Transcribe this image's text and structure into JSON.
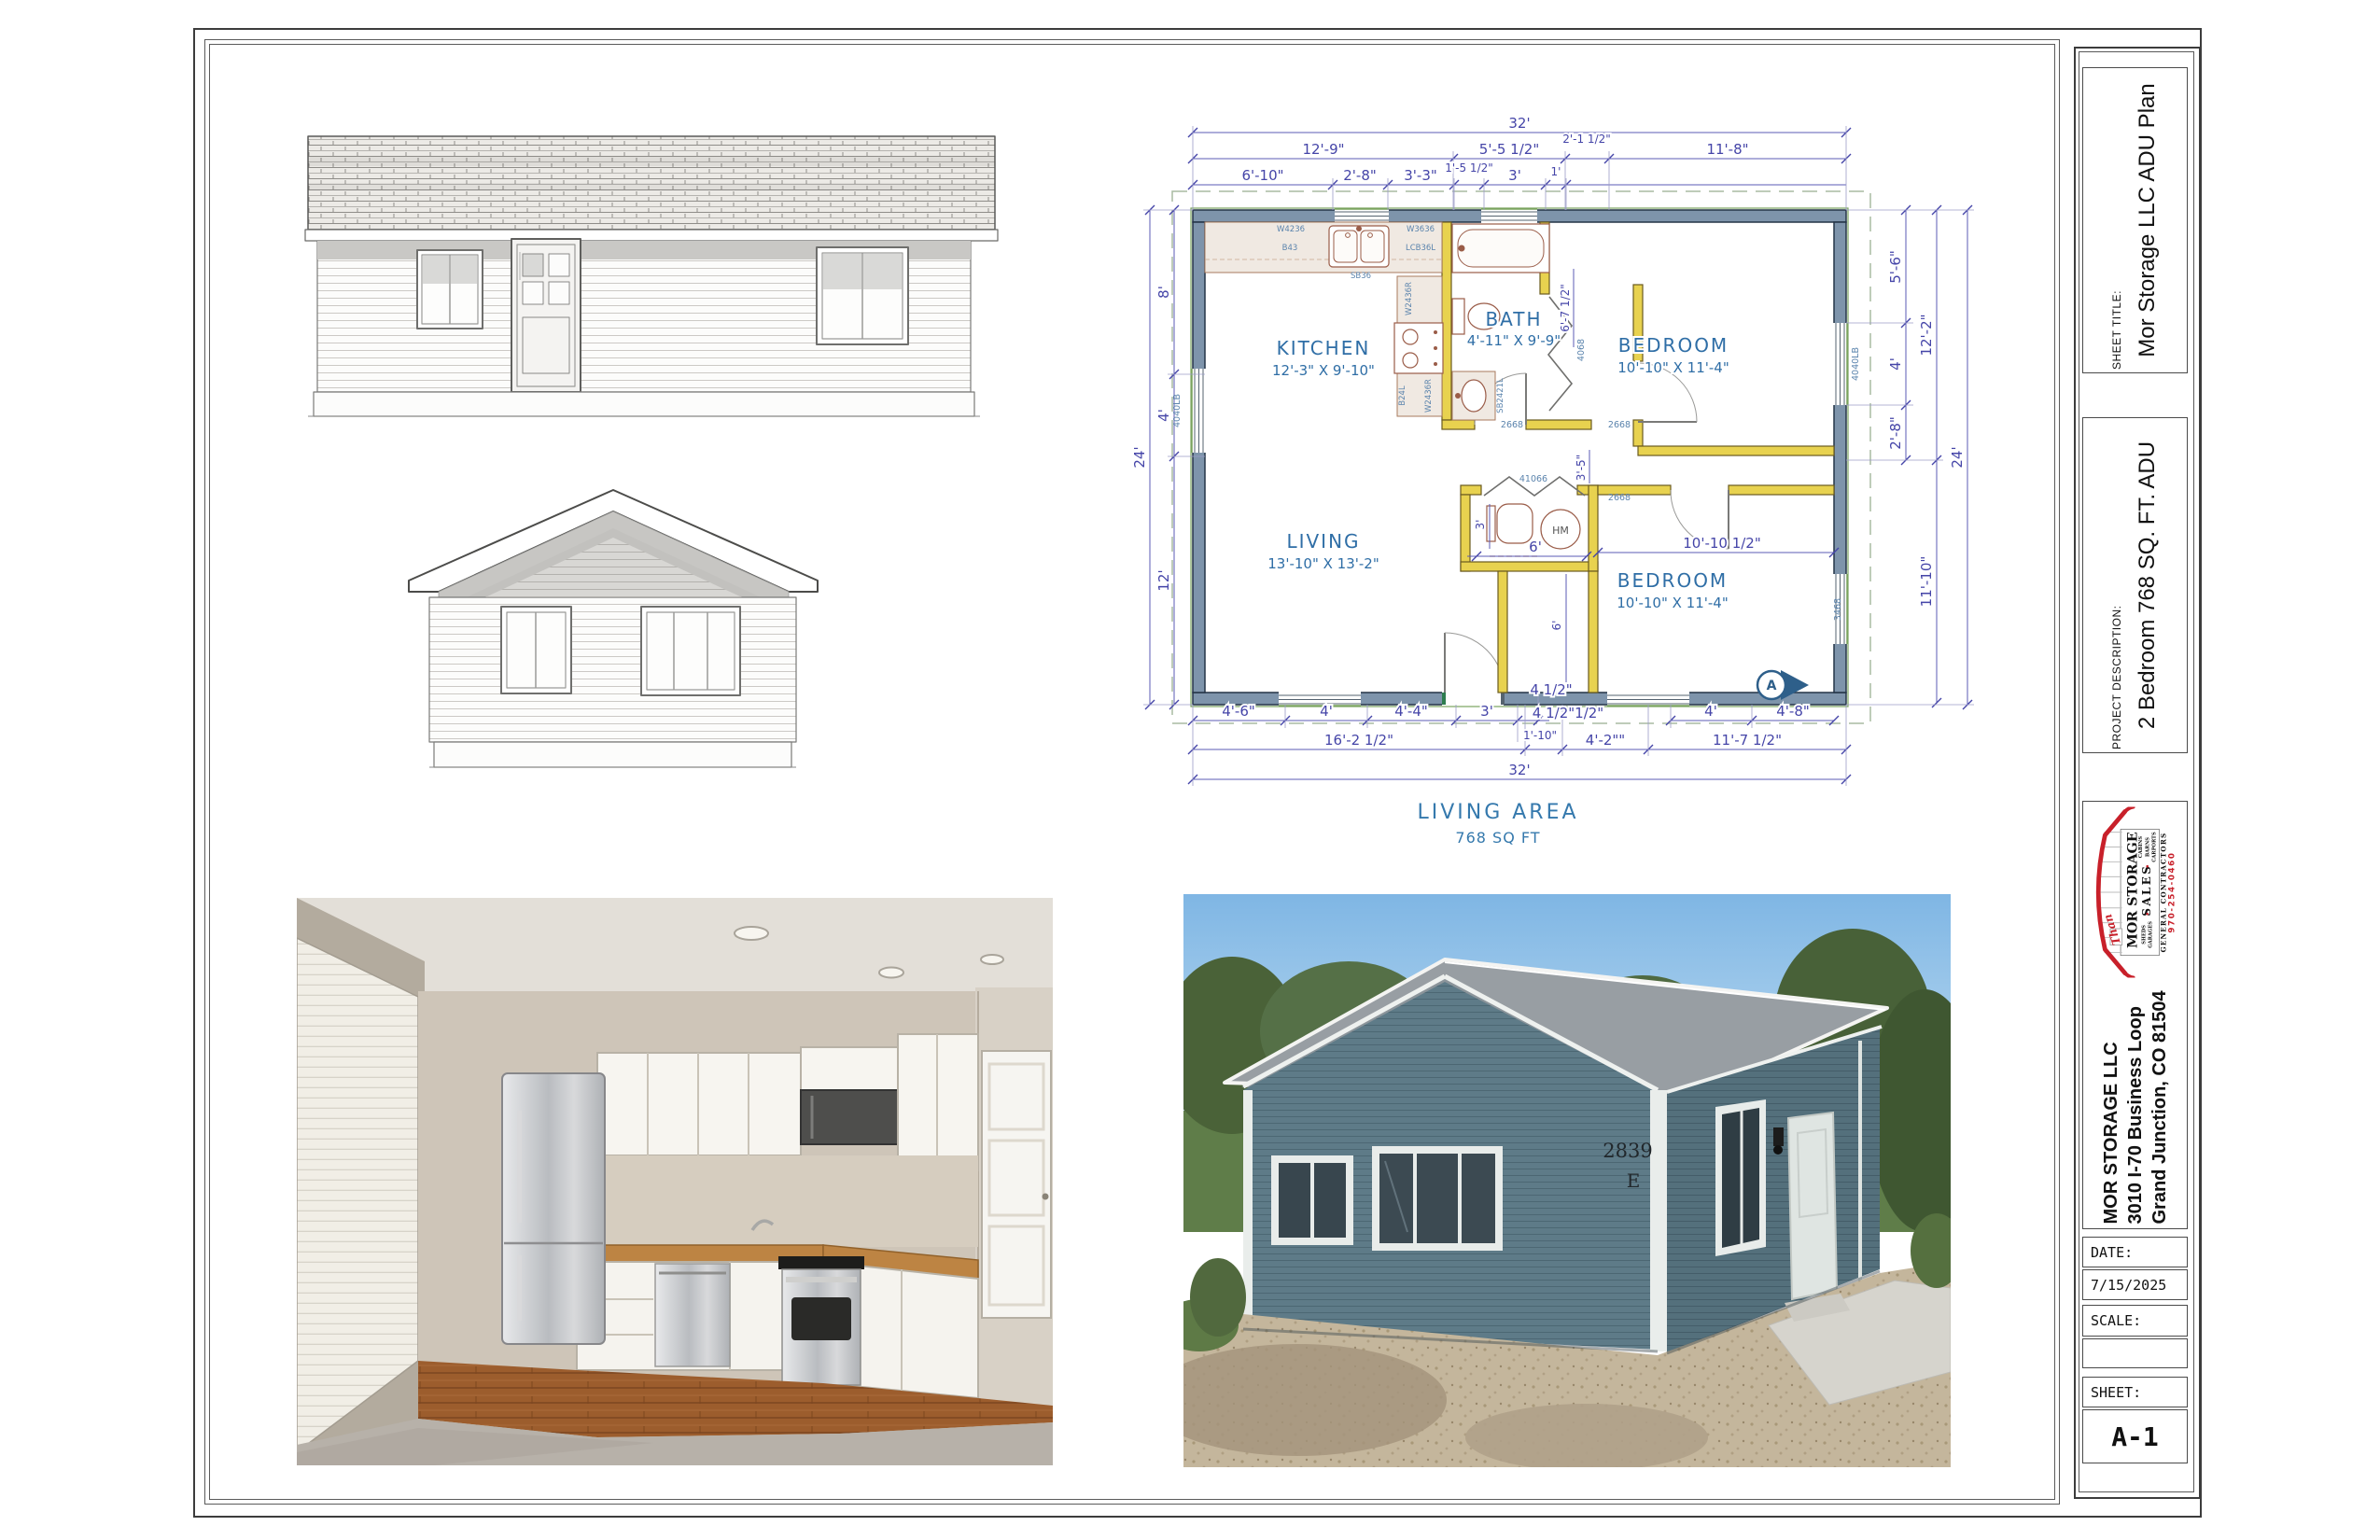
{
  "colors": {
    "wall_fill": "#7e94ab",
    "wall_stroke": "#243447",
    "partition_fill": "#e8d24f",
    "dim_text": "#4545a8",
    "label_text": "#2f6ea6",
    "logo_red": "#c8202a",
    "house_paint": "#5e7b88",
    "sky": "#8fc3ea",
    "counter_wood": "#bd8443"
  },
  "title_block": {
    "sheet_title_label": "SHEET TITLE:",
    "sheet_title": "Mor Storage LLC ADU Plan",
    "project_description_label": "PROJECT DESCRIPTION:",
    "project_description": "2 Bedroom 768 SQ. FT. ADU",
    "company_name": "MOR STORAGE LLC",
    "company_address_line1": "3010 I-70 Business Loop",
    "company_address_line2": "Grand Junction, CO 81504",
    "date_label": "DATE:",
    "date_value": "7/15/2025",
    "scale_label": "SCALE:",
    "scale_value": "",
    "sheet_label": "SHEET:",
    "sheet_number": "A-1",
    "logo": {
      "script": "Than",
      "line1": "MOR STORAGE",
      "line2": "SALES",
      "products": [
        "SHEDS",
        "GARAGES",
        "CABINS",
        "BARNS",
        "CARPORTS"
      ],
      "line3": "GENERAL CONTRACTORS",
      "phone": "970-254-0460"
    }
  },
  "floor_plan": {
    "caption": [
      "LIVING AREA",
      "768 SQ FT"
    ],
    "rooms": [
      {
        "name": "KITCHEN",
        "size": "12'-3\" X 9'-10\""
      },
      {
        "name": "BATH",
        "size": "4'-11\" X 9'-9\""
      },
      {
        "name": "BEDROOM",
        "size": "10'-10\" X 11'-4\""
      },
      {
        "name": "LIVING",
        "size": "13'-10\" X 13'-2\""
      },
      {
        "name": "BEDROOM",
        "size": "10'-10\" X 11'-4\""
      }
    ],
    "dims_top": [
      "32'",
      "12'-9\"",
      "5'-5 1/2\"",
      "2'-1 1/2\"",
      "11'-8\"",
      "6'-10\"",
      "2'-8\"",
      "3'-3\"",
      "1'-5 1/2\"",
      "3'",
      "1'"
    ],
    "dims_left": [
      "24'",
      "8'",
      "4'",
      "12'"
    ],
    "dims_right": [
      "5'-6\"",
      "4'",
      "2'-8\"",
      "12'-2\"",
      "11'-10\"",
      "24'"
    ],
    "dims_bottom": [
      "4'-6\"",
      "4'",
      "4'-4\"",
      "3'",
      "4 1/2\"",
      "4 1/2\"1/2\"",
      "16'-2 1/2\"",
      "1'-10\"",
      "4'-2\"\"",
      "11'-7 1/2\"",
      "4'",
      "4'-8\"",
      "32'"
    ],
    "dims_interior": [
      "6'-7 1/2\"",
      "3'-5\"",
      "3'",
      "6'",
      "6'",
      "10'-10 1/2\""
    ],
    "cabinet_labels": [
      "W4236",
      "B43",
      "SB36",
      "W3636",
      "LCB36L",
      "W2436R",
      "B24L",
      "W2436R",
      "SB2421L"
    ],
    "door_labels": [
      "2668",
      "2668",
      "2668"
    ],
    "window_labels": [
      "4040LB",
      "4040LB",
      "4068",
      "3468",
      "41066"
    ],
    "marker_a": "A",
    "water_heater_label": "HM"
  },
  "photos": {
    "exterior_address": [
      "2839",
      "E"
    ]
  }
}
